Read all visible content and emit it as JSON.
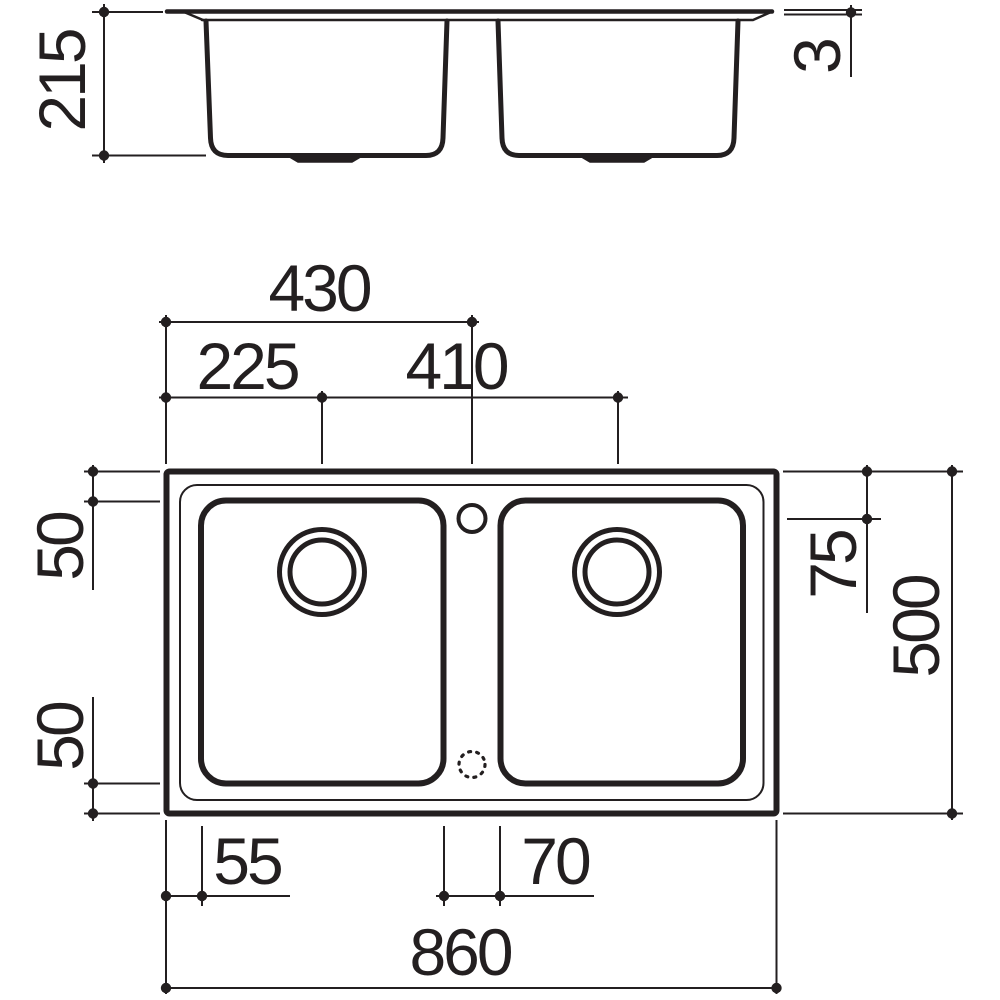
{
  "drawing": {
    "background": "#ffffff",
    "line_color": "#231f20",
    "elevation_view": {
      "description": "front elevation of double-bowl sink",
      "dimensions": {
        "bowl_depth": "215",
        "rim_thickness": "3"
      }
    },
    "plan_view": {
      "description": "top plan of double-bowl sink",
      "dimensions": {
        "center_from_left": "430",
        "drain_center_from_left": "225",
        "drain_spacing": "410",
        "rim_top_inset": "50",
        "rim_bottom_inset": "50",
        "tap_hole_offset": "75",
        "overall_depth": "500",
        "left_rim_width": "55",
        "divider_width": "70",
        "overall_width": "860"
      }
    }
  }
}
